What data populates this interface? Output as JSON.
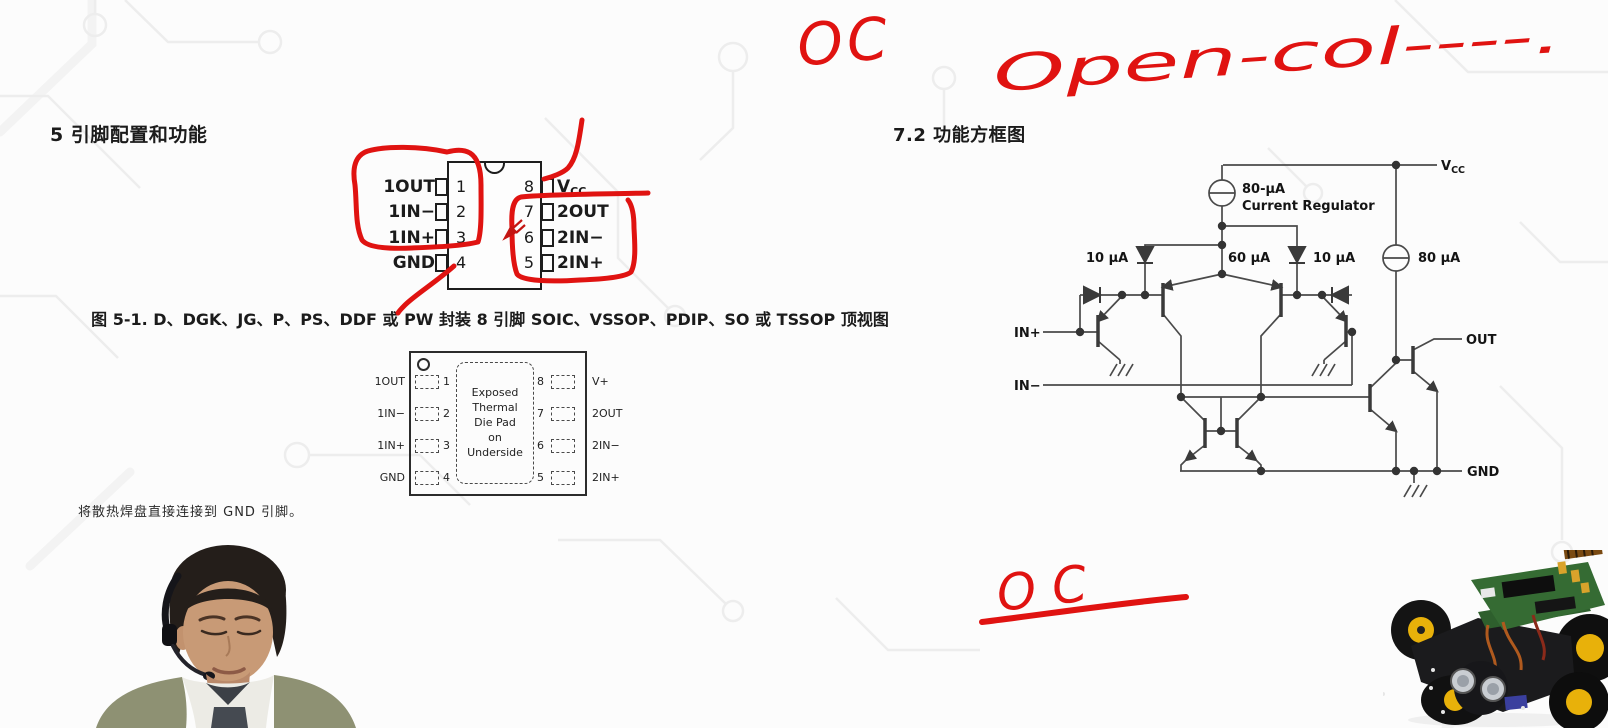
{
  "page": {
    "background": "#fcfcfc",
    "annotation_red": "#e01311",
    "ink": "#1b1b1b",
    "trace_gray": "#ededed"
  },
  "annotations": {
    "oc_top": "OC",
    "open_col": "Open-col----.",
    "oc_bottom": "OC"
  },
  "section5": {
    "title": "5 引脚配置和功能",
    "figure_caption": "图 5-1. D、DGK、JG、P、PS、DDF 或 PW 封装 8 引脚 SOIC、VSSOP、PDIP、SO 或 TSSOP 顶视图",
    "note": "将散热焊盘直接连接到 GND 引脚。"
  },
  "package1": {
    "left_pins": [
      {
        "num": "1",
        "label": "1OUT"
      },
      {
        "num": "2",
        "label": "1IN−"
      },
      {
        "num": "3",
        "label": "1IN+"
      },
      {
        "num": "4",
        "label": "GND"
      }
    ],
    "right_pins": [
      {
        "num": "8",
        "label_main": "V",
        "label_sub": "CC"
      },
      {
        "num": "7",
        "label": "2OUT"
      },
      {
        "num": "6",
        "label": "2IN−"
      },
      {
        "num": "5",
        "label": "2IN+"
      }
    ]
  },
  "package2": {
    "left_pins": [
      {
        "num": "1",
        "label": "1OUT"
      },
      {
        "num": "2",
        "label": "1IN−"
      },
      {
        "num": "3",
        "label": "1IN+"
      },
      {
        "num": "4",
        "label": "GND"
      }
    ],
    "right_pins": [
      {
        "num": "8",
        "label": "V+"
      },
      {
        "num": "7",
        "label": "2OUT"
      },
      {
        "num": "6",
        "label": "2IN−"
      },
      {
        "num": "5",
        "label": "2IN+"
      }
    ],
    "pad_lines": [
      "Exposed",
      "Thermal",
      "Die Pad",
      "on",
      "Underside"
    ]
  },
  "section72": {
    "title": "7.2 功能方框图"
  },
  "circuit": {
    "vcc_main": "V",
    "vcc_sub": "CC",
    "regulator_value": "80-μA",
    "regulator_label": "Current Regulator",
    "i_left": "10 μA",
    "i_center": "60 μA",
    "i_right": "10 μA",
    "i_out": "80 μA",
    "in_plus": "IN+",
    "in_minus": "IN−",
    "out": "OUT",
    "gnd": "GND"
  }
}
